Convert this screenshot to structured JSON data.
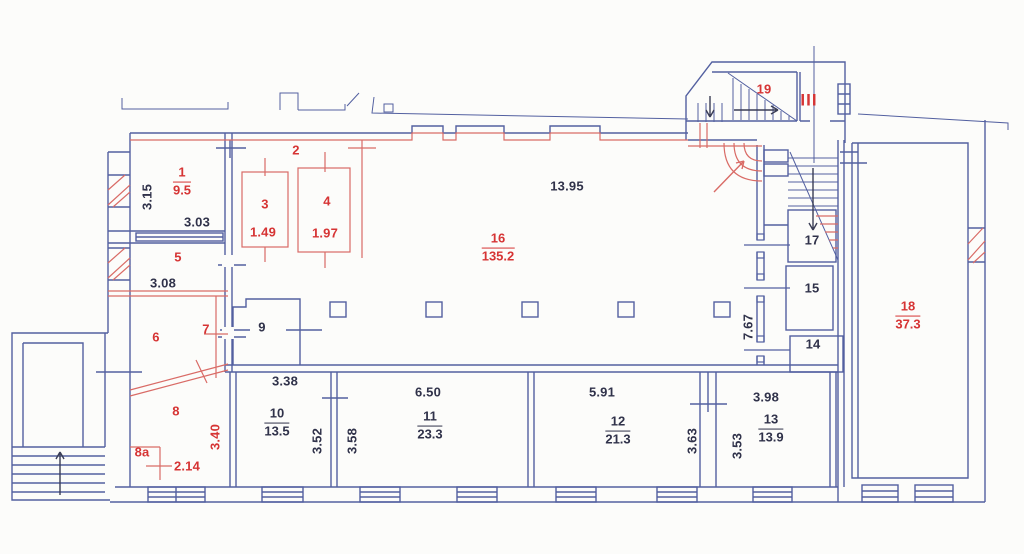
{
  "document": {
    "type": "apartment floor plan",
    "sheet_background": "#fcfcfa"
  },
  "colors": {
    "wall_line": "#5360a0",
    "red_line": "#d96b66",
    "text_dark": "#30324a",
    "text_red": "#d63434"
  },
  "entrance": {
    "label": "III"
  },
  "rooms": {
    "r1": {
      "number": "1",
      "area": "9.5"
    },
    "r2": {
      "number": "2"
    },
    "r3": {
      "number": "3",
      "area": "1.49"
    },
    "r4": {
      "number": "4",
      "area": "1.97"
    },
    "r5": {
      "number": "5"
    },
    "r6": {
      "number": "6"
    },
    "r7": {
      "number": "7"
    },
    "r8": {
      "number": "8"
    },
    "r8a": {
      "number": "8a"
    },
    "r9": {
      "number": "9"
    },
    "r10": {
      "number": "10",
      "area": "13.5"
    },
    "r11": {
      "number": "11",
      "area": "23.3"
    },
    "r12": {
      "number": "12",
      "area": "21.3"
    },
    "r13": {
      "number": "13",
      "area": "13.9"
    },
    "r14": {
      "number": "14"
    },
    "r15": {
      "number": "15"
    },
    "r16": {
      "number": "16",
      "area": "135.2"
    },
    "r17": {
      "number": "17"
    },
    "r18": {
      "number": "18",
      "area": "37.3"
    },
    "r19": {
      "number": "19"
    }
  },
  "dimensions": {
    "room1_height": "3.15",
    "room1_width": "3.03",
    "room5_width": "3.08",
    "room8_height": "3.40",
    "room8a_width": "2.14",
    "hall_width": "13.95",
    "hall_height": "7.67",
    "room10_width": "3.38",
    "room10_height": "3.52",
    "room11_height": "3.58",
    "room11_width": "6.50",
    "room12_width": "5.91",
    "corridor_height": "3.63",
    "room13_height": "3.53",
    "room13_width": "3.98"
  }
}
